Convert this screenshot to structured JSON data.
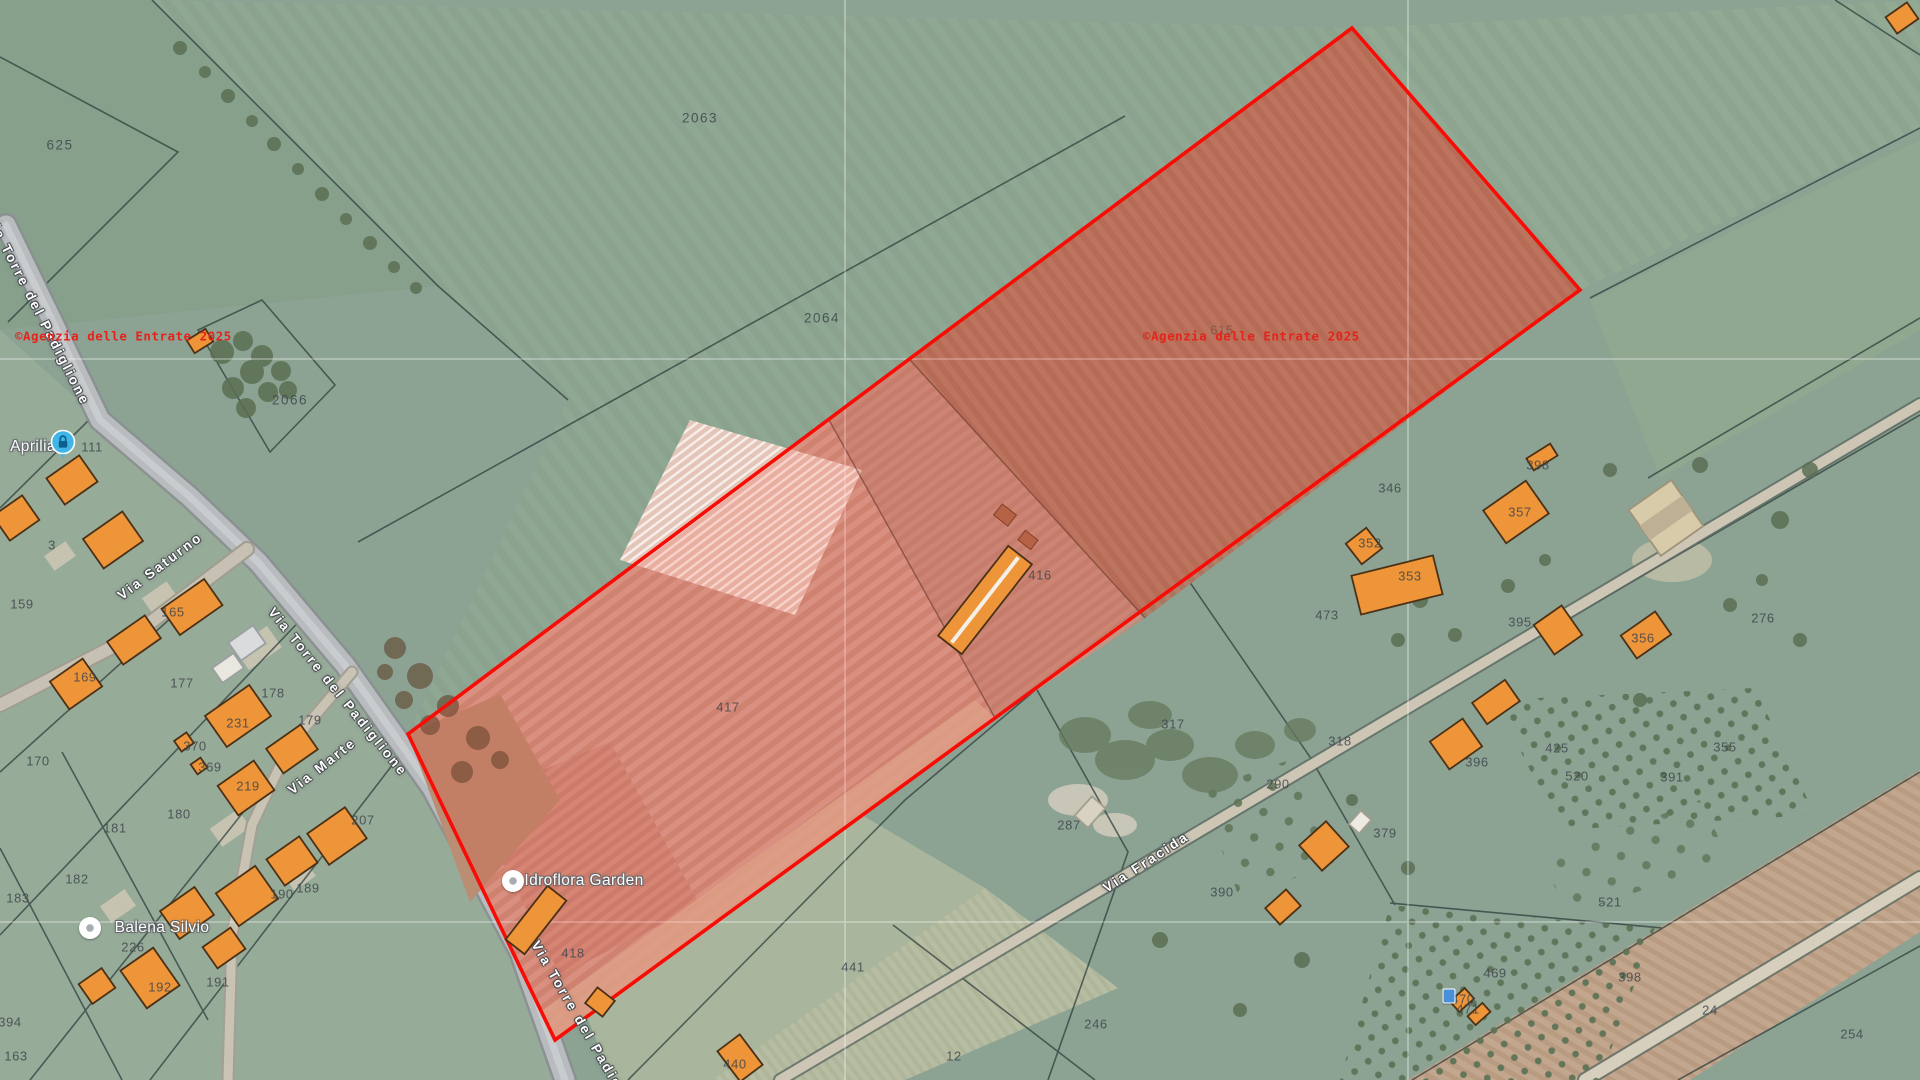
{
  "map": {
    "kind": "cadastral-satellite-view",
    "highlight_color": "#f80c06",
    "watermark_color": "#e6231b",
    "building_color": "#ee9439"
  },
  "watermarks": [
    {
      "text": "©Agenzia delle Entrate 2025",
      "x": 15,
      "y": 336
    },
    {
      "text": "©Agenzia delle Entrate 2025",
      "x": 1143,
      "y": 336
    }
  ],
  "place_labels": [
    {
      "text": "Aprilia",
      "x": 33,
      "y": 447
    },
    {
      "text": "Idroflora Garden",
      "x": 584,
      "y": 881
    },
    {
      "text": "Balena Silvio",
      "x": 162,
      "y": 928
    }
  ],
  "street_labels": [
    {
      "text": "Via Torre del Padiglione",
      "x": 38,
      "y": 310,
      "angle": 63
    },
    {
      "text": "Via Torre del Padiglione",
      "x": 338,
      "y": 692,
      "angle": 51
    },
    {
      "text": "Via Torre del Padiglione",
      "x": 588,
      "y": 1034,
      "angle": 60
    },
    {
      "text": "Via Saturno",
      "x": 160,
      "y": 566,
      "angle": -37
    },
    {
      "text": "Via Marte",
      "x": 322,
      "y": 766,
      "angle": -38
    },
    {
      "text": "Via Fracida",
      "x": 1146,
      "y": 862,
      "angle": -33
    }
  ],
  "markers": [
    {
      "type": "lock",
      "x": 63,
      "y": 447
    },
    {
      "type": "dot",
      "x": 513,
      "y": 881
    },
    {
      "type": "dot",
      "x": 90,
      "y": 928
    },
    {
      "type": "chip",
      "x": 1449,
      "y": 996
    }
  ],
  "parcel_labels": [
    {
      "t": "625",
      "x": 60,
      "y": 145,
      "big": true
    },
    {
      "t": "2063",
      "x": 700,
      "y": 118,
      "big": true
    },
    {
      "t": "2064",
      "x": 822,
      "y": 318,
      "big": true
    },
    {
      "t": "2066",
      "x": 290,
      "y": 400,
      "big": true
    },
    {
      "t": "615",
      "x": 1222,
      "y": 330,
      "faint": true
    },
    {
      "t": "111",
      "x": 92,
      "y": 447
    },
    {
      "t": "3",
      "x": 52,
      "y": 545
    },
    {
      "t": "159",
      "x": 22,
      "y": 604
    },
    {
      "t": "165",
      "x": 173,
      "y": 612
    },
    {
      "t": "169",
      "x": 85,
      "y": 677
    },
    {
      "t": "170",
      "x": 38,
      "y": 761
    },
    {
      "t": "177",
      "x": 182,
      "y": 683
    },
    {
      "t": "178",
      "x": 273,
      "y": 693
    },
    {
      "t": "179",
      "x": 310,
      "y": 720
    },
    {
      "t": "231",
      "x": 238,
      "y": 723
    },
    {
      "t": "370",
      "x": 195,
      "y": 746
    },
    {
      "t": "369",
      "x": 210,
      "y": 767
    },
    {
      "t": "219",
      "x": 248,
      "y": 786
    },
    {
      "t": "180",
      "x": 179,
      "y": 814
    },
    {
      "t": "181",
      "x": 115,
      "y": 828
    },
    {
      "t": "182",
      "x": 77,
      "y": 879
    },
    {
      "t": "183",
      "x": 18,
      "y": 898
    },
    {
      "t": "207",
      "x": 363,
      "y": 820
    },
    {
      "t": "189",
      "x": 308,
      "y": 888
    },
    {
      "t": "190",
      "x": 282,
      "y": 894
    },
    {
      "t": "226",
      "x": 133,
      "y": 947
    },
    {
      "t": "191",
      "x": 218,
      "y": 982
    },
    {
      "t": "192",
      "x": 160,
      "y": 987
    },
    {
      "t": "394",
      "x": 10,
      "y": 1022
    },
    {
      "t": "163",
      "x": 16,
      "y": 1056
    },
    {
      "t": "417",
      "x": 728,
      "y": 707
    },
    {
      "t": "416",
      "x": 1040,
      "y": 575
    },
    {
      "t": "418",
      "x": 573,
      "y": 953
    },
    {
      "t": "440",
      "x": 735,
      "y": 1064
    },
    {
      "t": "441",
      "x": 853,
      "y": 967
    },
    {
      "t": "12",
      "x": 954,
      "y": 1056
    },
    {
      "t": "246",
      "x": 1096,
      "y": 1024
    },
    {
      "t": "287",
      "x": 1069,
      "y": 825
    },
    {
      "t": "317",
      "x": 1173,
      "y": 724
    },
    {
      "t": "318",
      "x": 1340,
      "y": 741
    },
    {
      "t": "290",
      "x": 1278,
      "y": 784
    },
    {
      "t": "379",
      "x": 1385,
      "y": 833
    },
    {
      "t": "390",
      "x": 1222,
      "y": 892
    },
    {
      "t": "398",
      "x": 1538,
      "y": 465
    },
    {
      "t": "346",
      "x": 1390,
      "y": 488
    },
    {
      "t": "357",
      "x": 1520,
      "y": 512
    },
    {
      "t": "352",
      "x": 1370,
      "y": 543
    },
    {
      "t": "353",
      "x": 1410,
      "y": 576
    },
    {
      "t": "473",
      "x": 1327,
      "y": 615
    },
    {
      "t": "395",
      "x": 1520,
      "y": 622
    },
    {
      "t": "356",
      "x": 1643,
      "y": 638
    },
    {
      "t": "276",
      "x": 1763,
      "y": 618
    },
    {
      "t": "355",
      "x": 1725,
      "y": 747
    },
    {
      "t": "425",
      "x": 1557,
      "y": 748
    },
    {
      "t": "520",
      "x": 1577,
      "y": 776
    },
    {
      "t": "391",
      "x": 1672,
      "y": 777
    },
    {
      "t": "396",
      "x": 1477,
      "y": 762
    },
    {
      "t": "521",
      "x": 1610,
      "y": 902
    },
    {
      "t": "469",
      "x": 1495,
      "y": 973
    },
    {
      "t": "470",
      "x": 1463,
      "y": 999
    },
    {
      "t": "471",
      "x": 1468,
      "y": 1009
    },
    {
      "t": "398",
      "x": 1630,
      "y": 977
    },
    {
      "t": "24",
      "x": 1710,
      "y": 1010
    },
    {
      "t": "254",
      "x": 1852,
      "y": 1034
    }
  ]
}
